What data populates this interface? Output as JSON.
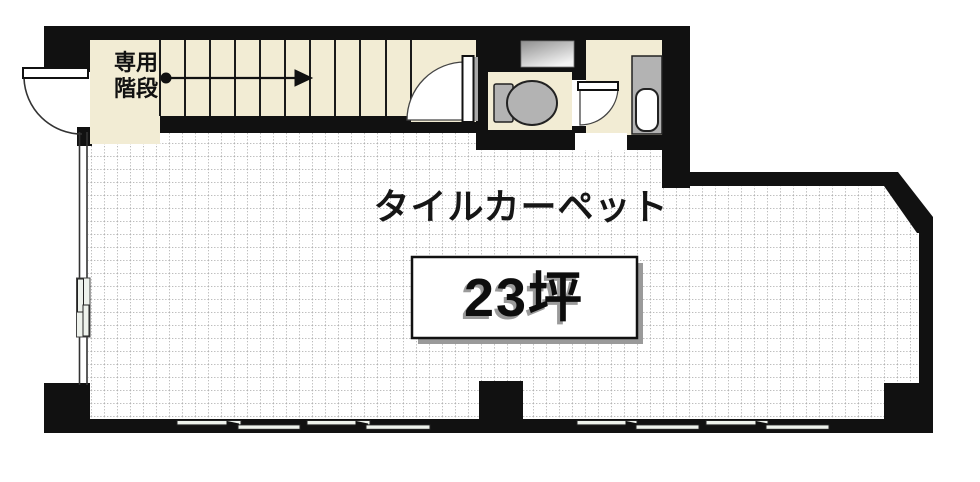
{
  "plan": {
    "labels": {
      "stairs_line1": "専用",
      "stairs_line2": "階段",
      "room_finish": "タイルカーペット",
      "area": "23坪"
    },
    "rooms": {
      "main_room_finish": "タイルカーペット",
      "main_room_area": "23坪",
      "stairwell": "専用階段"
    },
    "colors": {
      "wall": "#111111",
      "room_cream": "#f2ecd4",
      "fixture_gray": "#b3b3b3",
      "floor_dot": "#9a9a9a",
      "window_tint": "#eef2ec",
      "shadow_gray": "#9a9a9a"
    }
  }
}
